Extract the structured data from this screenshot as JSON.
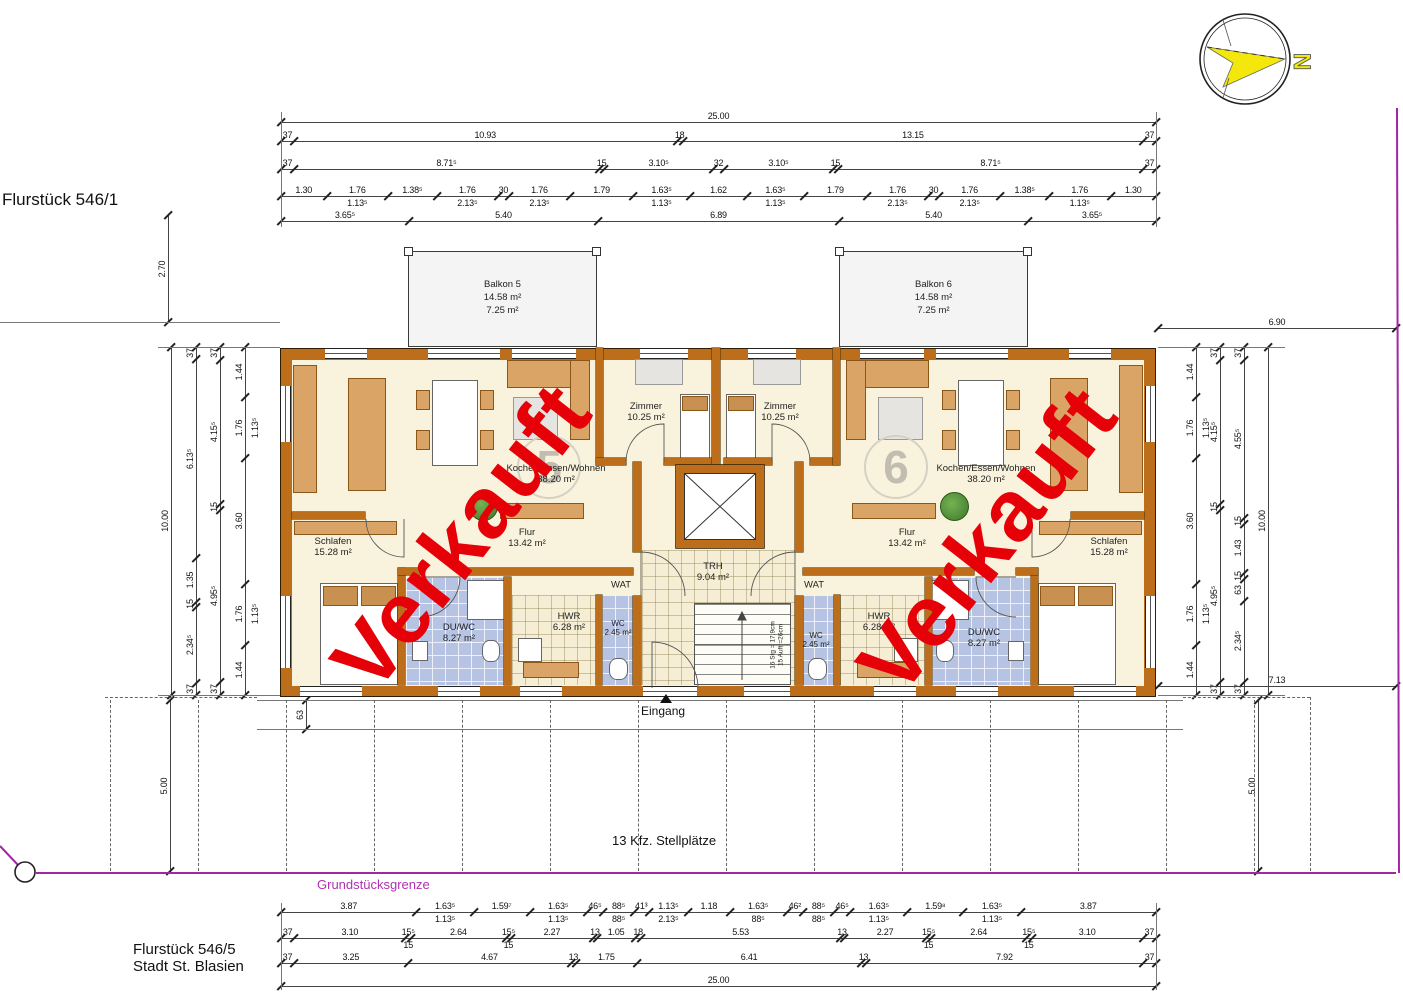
{
  "texts": {
    "flurstueck_top": "Flurstück 546/1",
    "flurstueck_bottom_line1": "Flurstück 546/5",
    "flurstueck_bottom_line2": "Stadt St. Blasien",
    "grundstuecksgrenze": "Grundstücksgrenze",
    "parking": "13 Kfz. Stellplätze",
    "eingang": "Eingang",
    "north": "N",
    "stamp": "Verkauft"
  },
  "apartment_numbers": [
    "5",
    "6"
  ],
  "balconies": [
    {
      "name": "Balkon 5",
      "area_total": "14.58 m²",
      "area_counted": "7.25 m²"
    },
    {
      "name": "Balkon 6",
      "area_total": "14.58 m²",
      "area_counted": "7.25 m²"
    }
  ],
  "rooms": [
    {
      "id": "zimmer-5",
      "name": "Zimmer",
      "area": "10.25 m²",
      "x": 646,
      "y": 412
    },
    {
      "id": "kochen-5",
      "name": "Kochen/Essen/Wohnen",
      "area": "38.20 m²",
      "x": 556,
      "y": 474
    },
    {
      "id": "flur-5",
      "name": "Flur",
      "area": "13.42 m²",
      "x": 527,
      "y": 538
    },
    {
      "id": "schlafen-5",
      "name": "Schlafen",
      "area": "15.28 m²",
      "x": 333,
      "y": 547
    },
    {
      "id": "duwc-5",
      "name": "DU/WC",
      "area": "8.27 m²",
      "x": 459,
      "y": 633
    },
    {
      "id": "hwr-5",
      "name": "HWR",
      "area": "6.28 m²",
      "x": 569,
      "y": 622
    },
    {
      "id": "wc-5",
      "name": "WC",
      "area": "2.45 m²",
      "x": 618,
      "y": 628,
      "small": true
    },
    {
      "id": "wat-5",
      "name": "WAT",
      "area": "",
      "x": 621,
      "y": 585
    },
    {
      "id": "trh",
      "name": "TRH",
      "area": "9.04 m²",
      "x": 713,
      "y": 572
    },
    {
      "id": "wat-6",
      "name": "WAT",
      "area": "",
      "x": 814,
      "y": 585
    },
    {
      "id": "zimmer-6",
      "name": "Zimmer",
      "area": "10.25 m²",
      "x": 780,
      "y": 412
    },
    {
      "id": "kochen-6",
      "name": "Kochen/Essen/Wohnen",
      "area": "38.20 m²",
      "x": 986,
      "y": 474
    },
    {
      "id": "flur-6",
      "name": "Flur",
      "area": "13.42 m²",
      "x": 907,
      "y": 538
    },
    {
      "id": "schlafen-6",
      "name": "Schlafen",
      "area": "15.28 m²",
      "x": 1109,
      "y": 547
    },
    {
      "id": "wc-6",
      "name": "WC",
      "area": "2.45 m²",
      "x": 816,
      "y": 640,
      "small": true
    },
    {
      "id": "hwr-6",
      "name": "HWR",
      "area": "6.28 m²",
      "x": 879,
      "y": 622
    },
    {
      "id": "duwc-6",
      "name": "DU/WC",
      "area": "8.27 m²",
      "x": 984,
      "y": 638
    }
  ],
  "stairs_note": [
    "16 Stg = 17,9cm",
    "15 Auftr=26cm"
  ],
  "dimensions": {
    "chains": [
      {
        "id": "top-total",
        "o": "h",
        "x": 281,
        "y": 122,
        "len": 875,
        "values": [
          25
        ],
        "labels": [
          "25.00"
        ]
      },
      {
        "id": "top-2",
        "o": "h",
        "x": 281,
        "y": 141,
        "len": 875,
        "values": [
          0.37,
          10.93,
          0.18,
          13.15,
          0.37
        ],
        "labels": [
          "37",
          "10.93",
          "18",
          "13.15",
          "37"
        ]
      },
      {
        "id": "top-3",
        "o": "h",
        "x": 281,
        "y": 169,
        "len": 875,
        "values": [
          0.37,
          8.715,
          0.15,
          3.105,
          0.32,
          3.105,
          0.15,
          8.715,
          0.37
        ],
        "labels": [
          "37",
          "8.71⁵",
          "15",
          "3.10⁵",
          "32",
          "3.10⁵",
          "15",
          "8.71⁵",
          "37"
        ]
      },
      {
        "id": "top-4",
        "o": "h",
        "x": 281,
        "y": 196,
        "len": 875,
        "values": [
          1.3,
          1.76,
          1.385,
          1.76,
          0.3,
          1.76,
          1.79,
          1.635,
          1.62,
          1.635,
          1.79,
          1.76,
          0.3,
          1.76,
          1.385,
          1.76,
          1.3
        ],
        "labels": [
          "1.30",
          "1.76",
          "1.38⁵",
          "1.76",
          "30",
          "1.76",
          "1.79",
          "1.63⁵",
          "1.62",
          "1.63⁵",
          "1.79",
          "1.76",
          "30",
          "1.76",
          "1.38⁵",
          "1.76",
          "1.30"
        ],
        "subs": [
          [
            1,
            "1.13⁵"
          ],
          [
            3,
            "2.13⁵"
          ],
          [
            5,
            "2.13⁵"
          ],
          [
            7,
            "1.13⁵"
          ],
          [
            9,
            "1.13⁵"
          ],
          [
            11,
            "2.13⁵"
          ],
          [
            13,
            "2.13⁵"
          ],
          [
            15,
            "1.13⁵"
          ]
        ]
      },
      {
        "id": "top-5",
        "o": "h",
        "x": 281,
        "y": 221,
        "len": 875,
        "values": [
          3.655,
          5.4,
          6.89,
          5.4,
          3.655
        ],
        "labels": [
          "3.65⁵",
          "5.40",
          "6.89",
          "5.40",
          "3.65⁵"
        ]
      },
      {
        "id": "bottom-1",
        "o": "h",
        "x": 281,
        "y": 912,
        "len": 875,
        "values": [
          3.87,
          1.635,
          1.597,
          1.635,
          0.465,
          0.885,
          0.413,
          1.135,
          1.18,
          1.635,
          0.462,
          0.885,
          0.465,
          1.635,
          1.598,
          1.635,
          3.87
        ],
        "labels": [
          "3.87",
          "1.63⁵",
          "1.59⁷",
          "1.63⁵",
          "46⁵",
          "88⁵",
          "41³",
          "1.13⁵",
          "1.18",
          "1.63⁵",
          "46²",
          "88⁵",
          "46⁵",
          "1.63⁵",
          "1.59⁸",
          "1.63⁵",
          "3.87"
        ],
        "subs": [
          [
            1,
            "1.13⁵"
          ],
          [
            3,
            "1.13⁵"
          ],
          [
            5,
            "88⁵"
          ],
          [
            7,
            "2.13⁵"
          ],
          [
            9,
            "88⁵"
          ],
          [
            11,
            "88⁵"
          ],
          [
            13,
            "1.13⁵"
          ],
          [
            15,
            "1.13⁵"
          ]
        ]
      },
      {
        "id": "bottom-2",
        "o": "h",
        "x": 281,
        "y": 938,
        "len": 875,
        "values": [
          0.37,
          3.1,
          0.155,
          2.64,
          0.155,
          2.27,
          0.13,
          1.05,
          0.18,
          5.53,
          0.13,
          2.27,
          0.155,
          2.64,
          0.155,
          3.1,
          0.37
        ],
        "labels": [
          "37",
          "3.10",
          "15⁵",
          "2.64",
          "15⁵",
          "2.27",
          "13",
          "1.05",
          "18",
          "5.53",
          "13",
          "2.27",
          "15⁵",
          "2.64",
          "15⁵",
          "3.10",
          "37"
        ],
        "subs": [
          [
            2,
            "15"
          ],
          [
            4,
            "15"
          ],
          [
            12,
            "15"
          ],
          [
            14,
            "15"
          ]
        ]
      },
      {
        "id": "bottom-3",
        "o": "h",
        "x": 281,
        "y": 963,
        "len": 875,
        "values": [
          0.37,
          3.25,
          4.67,
          0.13,
          1.75,
          6.41,
          0.13,
          7.92,
          0.37
        ],
        "labels": [
          "37",
          "3.25",
          "4.67",
          "13",
          "1.75",
          "6.41",
          "13",
          "7.92",
          "37"
        ]
      },
      {
        "id": "bottom-total",
        "o": "h",
        "x": 281,
        "y": 986,
        "len": 875,
        "values": [
          25
        ],
        "labels": [
          "25.00"
        ]
      },
      {
        "id": "left-total",
        "o": "v",
        "x": 171,
        "y": 347,
        "len": 348,
        "values": [
          10
        ],
        "labels": [
          "10.00"
        ]
      },
      {
        "id": "left-2",
        "o": "v",
        "x": 196,
        "y": 347,
        "len": 348,
        "values": [
          0.37,
          6.135,
          1.35,
          0.15,
          2.345,
          0.37
        ],
        "labels": [
          "37",
          "6.13⁵",
          "1.35",
          "15",
          "2.34⁵",
          "37"
        ]
      },
      {
        "id": "left-3",
        "o": "v",
        "x": 220,
        "y": 347,
        "len": 348,
        "values": [
          0.37,
          4.155,
          0.15,
          4.955,
          0.37
        ],
        "labels": [
          "37",
          "4.15⁵",
          "15",
          "4.95⁵",
          "37"
        ]
      },
      {
        "id": "left-4",
        "o": "v",
        "x": 245,
        "y": 347,
        "len": 348,
        "values": [
          1.44,
          1.76,
          3.6,
          1.76,
          1.44
        ],
        "labels": [
          "1.44",
          "1.76",
          "3.60",
          "1.76",
          "1.44"
        ],
        "subs": [
          [
            1,
            "1.13⁵"
          ],
          [
            3,
            "1.13⁵"
          ]
        ]
      },
      {
        "id": "right-1",
        "o": "v",
        "x": 1196,
        "y": 347,
        "len": 348,
        "values": [
          1.44,
          1.76,
          3.6,
          1.76,
          1.44
        ],
        "labels": [
          "1.44",
          "1.76",
          "3.60",
          "1.76",
          "1.44"
        ],
        "subs": [
          [
            1,
            "1.13⁵"
          ],
          [
            3,
            "1.13⁵"
          ]
        ]
      },
      {
        "id": "right-2",
        "o": "v",
        "x": 1220,
        "y": 347,
        "len": 348,
        "values": [
          0.37,
          4.155,
          0.15,
          4.955,
          0.37
        ],
        "labels": [
          "37",
          "4.15⁵",
          "15",
          "4.95⁵",
          "37"
        ]
      },
      {
        "id": "right-3",
        "o": "v",
        "x": 1244,
        "y": 347,
        "len": 348,
        "values": [
          0.37,
          4.555,
          0.15,
          1.43,
          0.15,
          0.63,
          2.345,
          0.37
        ],
        "labels": [
          "37",
          "4.55⁵",
          "15",
          "1.43",
          "15",
          "63",
          "2.34⁵",
          "37"
        ]
      },
      {
        "id": "right-total",
        "o": "v",
        "x": 1268,
        "y": 347,
        "len": 348,
        "values": [
          10
        ],
        "labels": [
          "10.00"
        ]
      },
      {
        "id": "balcony-depth",
        "o": "v",
        "x": 168,
        "y": 215,
        "len": 107,
        "values": [
          2.7
        ],
        "labels": [
          "2.70"
        ]
      },
      {
        "id": "right-top",
        "o": "h",
        "x": 1158,
        "y": 328,
        "len": 238,
        "values": [
          6.9
        ],
        "labels": [
          "6.90"
        ]
      },
      {
        "id": "right-bottom",
        "o": "h",
        "x": 1158,
        "y": 686,
        "len": 238,
        "values": [
          7.13
        ],
        "labels": [
          "7.13"
        ]
      },
      {
        "id": "parking-left",
        "o": "v",
        "x": 170,
        "y": 700,
        "len": 171,
        "values": [
          5.0
        ],
        "labels": [
          "5.00"
        ]
      },
      {
        "id": "parking-right",
        "o": "v",
        "x": 1258,
        "y": 700,
        "len": 171,
        "values": [
          5.0
        ],
        "labels": [
          "5.00"
        ]
      },
      {
        "id": "walkway",
        "o": "v",
        "x": 306,
        "y": 700,
        "len": 29,
        "values": [
          0.63
        ],
        "labels": [
          "63"
        ]
      }
    ]
  },
  "colors": {
    "wall": "#bc6e1a",
    "floor": "#f9f3dd",
    "bath_tile": "#b6c3e2",
    "stamp_red": "#e60008",
    "boundary_magenta": "#a326a3",
    "compass_yellow": "#f3e70c",
    "balcony_fill": "#f4f4f4"
  }
}
